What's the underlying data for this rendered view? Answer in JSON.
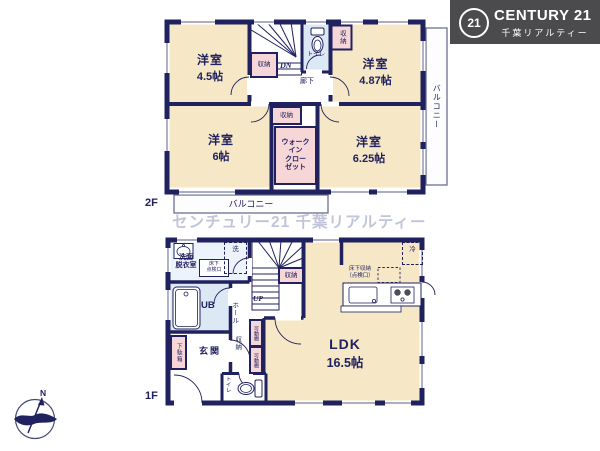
{
  "colors": {
    "wall": "#20215f",
    "room_cream": "#f6e8c6",
    "closet_pink": "#f7d6d7",
    "wet_floor_blue": "#dce8f4",
    "logo_bg": "#4b4b4d",
    "watermark": "#c2c5d9"
  },
  "logo": {
    "badge": "21",
    "brand": "CENTURY 21",
    "subtitle": "千葉リアルティー"
  },
  "watermark": "センチュリー21 千葉リアルティー",
  "compass": {
    "north": "N"
  },
  "floor2": {
    "label": "2F",
    "room_nw": {
      "name": "洋室",
      "size": "4.5帖"
    },
    "room_ne": {
      "name": "洋室",
      "size": "4.87帖"
    },
    "room_sw": {
      "name": "洋室",
      "size": "6帖"
    },
    "room_se": {
      "name": "洋室",
      "size": "6.25帖"
    },
    "stairs": "DN",
    "hallway": "廊下",
    "toilet": "トイレ",
    "closet_by_stairs": "収納",
    "closet_ne": "収納",
    "closet_center": "収納",
    "wic": "ウォーク\nイン\nクロー\nゼット",
    "balcony_right": "バルコニー",
    "balcony_bottom": "バルコニー"
  },
  "floor1": {
    "label": "1F",
    "ldk": {
      "name": "LDK",
      "size": "16.5帖"
    },
    "washroom": "洗面\n脱衣室",
    "inspection_hatch": "床下\n点検口",
    "washer": "洗",
    "unit_bath": "UB",
    "stairs": "UP",
    "hall": "ホール",
    "closet_by_stairs": "収納",
    "shoe_cabinet": "下駄箱",
    "entrance": "玄関",
    "hall_closet": "収納",
    "shelf_top": "可動棚",
    "shelf_bottom": "可動棚",
    "toilet": "トイレ",
    "fridge": "冷",
    "underfloor_storage": "床下収納\n（点検口）"
  }
}
